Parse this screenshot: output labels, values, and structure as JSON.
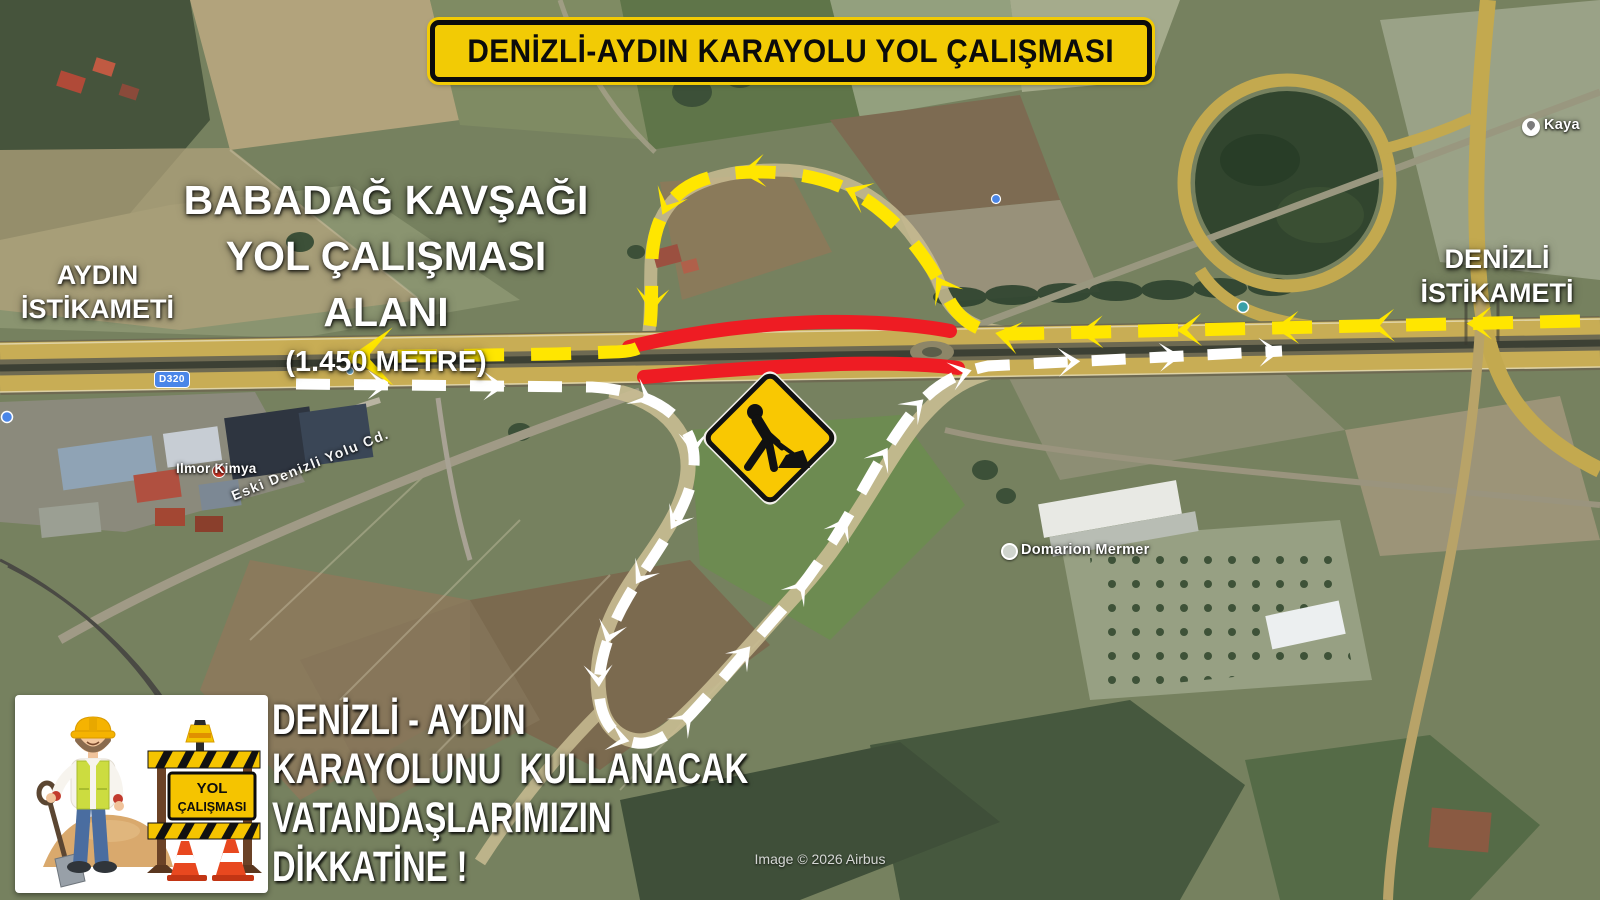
{
  "banner": {
    "title": "DENİZLİ-AYDIN KARAYOLU YOL ÇALIŞMASI"
  },
  "work_area": {
    "line1": "BABADAĞ KAVŞAĞI",
    "line2": "YOL ÇALIŞMASI ALANI",
    "line3": "(1.450 METRE)"
  },
  "directions": {
    "west": {
      "line1": "AYDIN",
      "line2": "İSTİKAMETİ"
    },
    "east": {
      "line1": "DENİZLİ",
      "line2": "İSTİKAMETİ"
    }
  },
  "announcement": {
    "line1": "DENİZLİ - AYDIN",
    "line2": "KARAYOLUNU  KULLANACAK",
    "line3": "VATANDAŞLARIMIZIN",
    "line4": "DİKKATİNE !"
  },
  "roadwork_card": {
    "sign_line1": "YOL",
    "sign_line2": "ÇALIŞMASI"
  },
  "map": {
    "road_shield": "D320",
    "street_label": "Eski Denizli Yolu Cd.",
    "poi_labels": [
      "Ilmor Kimya",
      "Domarion Mermer",
      "Kaya"
    ],
    "attribution": "Image © 2026 Airbus"
  },
  "colors": {
    "closed_road": "#EE1C23",
    "detour_westbound": "#FFE600",
    "detour_eastbound": "#FFFFFF",
    "banner_yellow": "#F2CB05",
    "warning_sign_yellow": "#F9C802"
  }
}
